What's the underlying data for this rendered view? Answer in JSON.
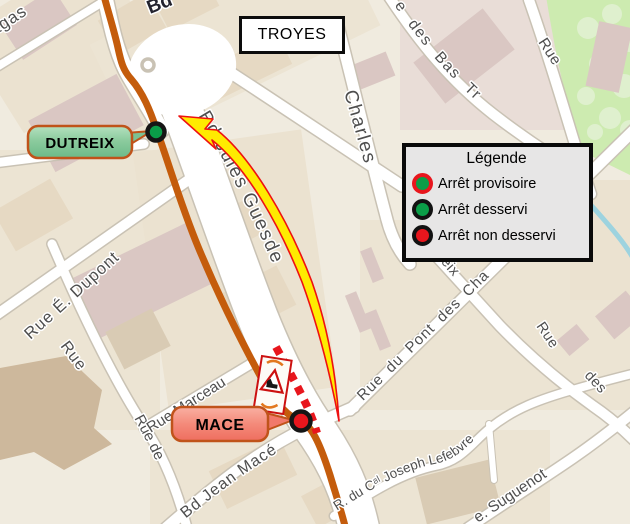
{
  "map": {
    "city_box": "TROYES",
    "legend": {
      "title": "Légende",
      "items": [
        {
          "label": "Arrêt provisoire",
          "circle_fill": "#0a9e48",
          "circle_ring": "#e8161d"
        },
        {
          "label": "Arrêt desservi",
          "circle_fill": "#0a9e48",
          "circle_ring": "#121212"
        },
        {
          "label": "Arrêt non desservi",
          "circle_fill": "#e8161d",
          "circle_ring": "#121212"
        }
      ]
    },
    "stops": [
      {
        "label": "DUTREIX",
        "status": "Arrêt desservi",
        "marker_fill": "#0a9e48"
      },
      {
        "label": "MACE",
        "status": "Arrêt non desservi",
        "marker_fill": "#e8161d"
      }
    ],
    "street_labels": {
      "top_left_fragment": "agas",
      "top_fragment": "Bd",
      "charles": "Charles",
      "bas_trevois": "e des Bas Tr",
      "rue_top_right": "Rue",
      "jules_guesde": "Bd Jules Guesde",
      "dupont": "Rue É. Dupont",
      "rue_left": "Rue",
      "rue_de": "Rue de",
      "marceau": "Rue Marceau",
      "jean_mace": "Bd Jean Macé",
      "dutreix_fragment": "reix",
      "pont_des_chaines": "Rue du Pont des Cha",
      "rue_right": "Rue",
      "des_right": "des",
      "lefebvre": "R. du Cᵃˡ Joseph Lefebvre",
      "suguenot": "e. Suguenot"
    },
    "colors": {
      "route": "#c45c0c",
      "closure_dash": "#e8161d",
      "arrow_fill": "#ffeb00",
      "arrow_outline": "#ee1111",
      "stop_served": "#0a9e48",
      "stop_not_served": "#e8161d",
      "callout_border": "#c0531a",
      "park": "#cdebb0",
      "water": "#9dd3df"
    }
  }
}
